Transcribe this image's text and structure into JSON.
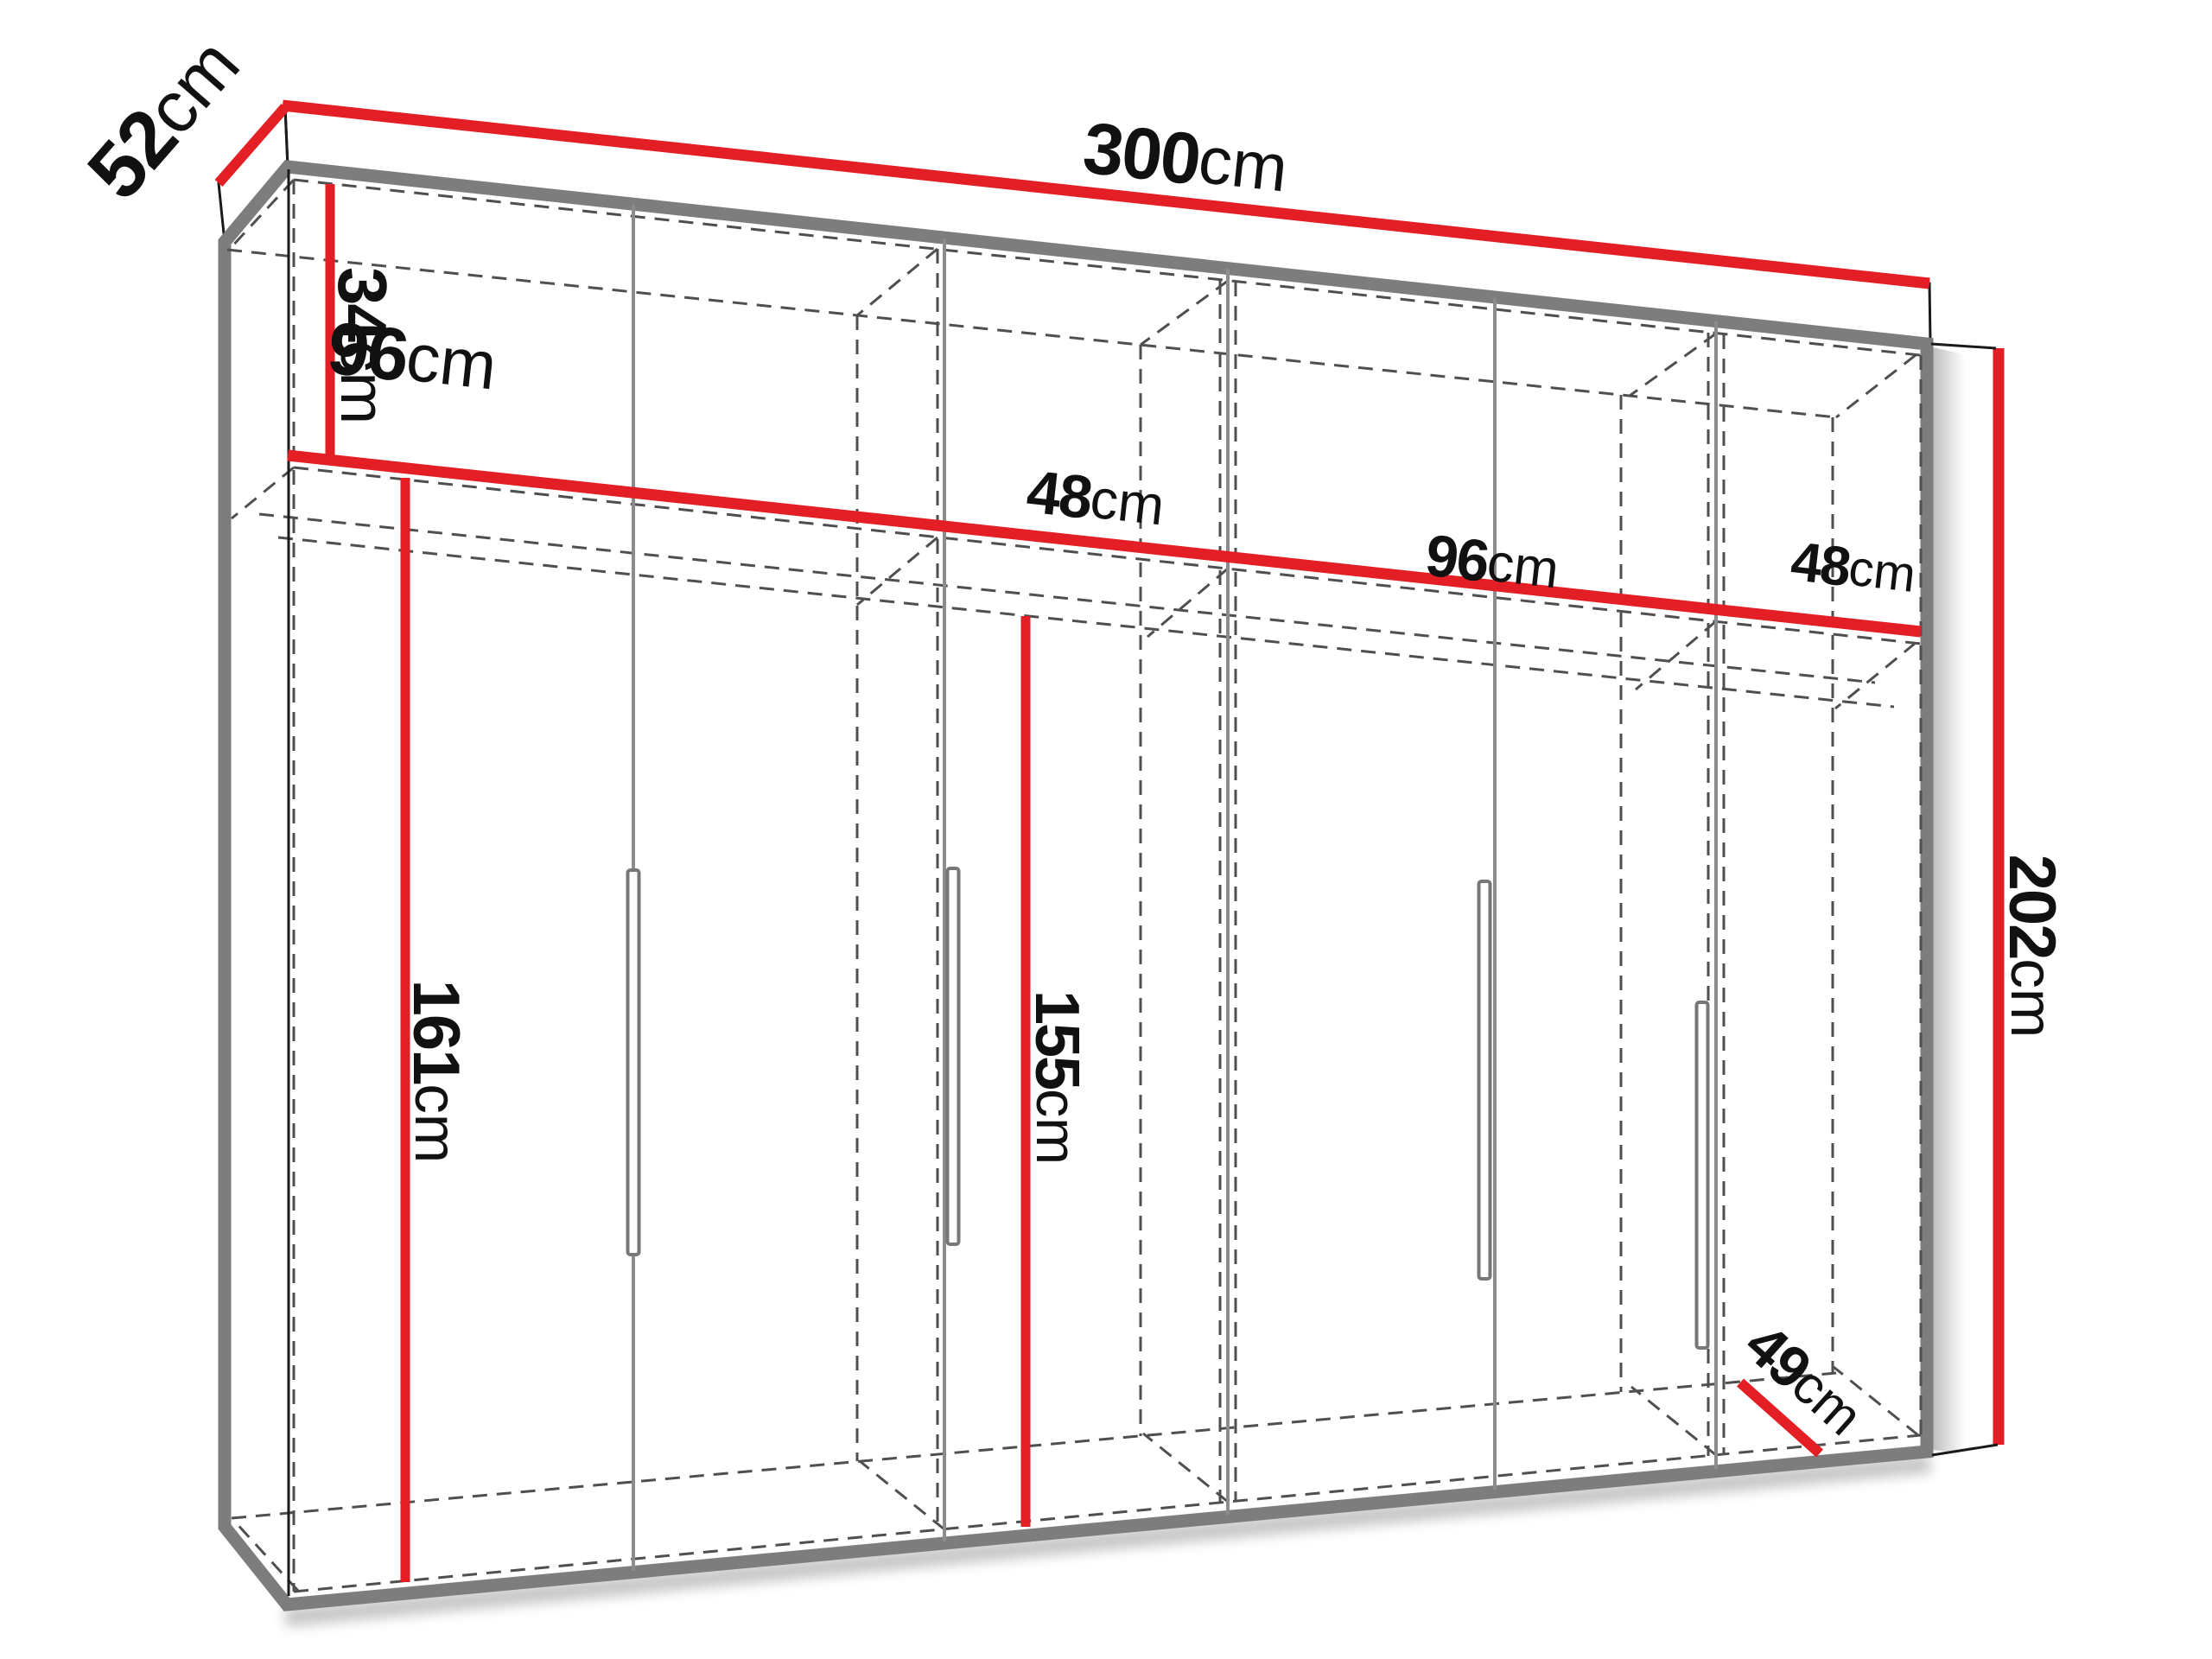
{
  "diagram": {
    "kind": "furniture-dimension-diagram",
    "subject": "wardrobe",
    "unit": "cm",
    "colors": {
      "dimension_line": "#e31e24",
      "edge": "#7d7d7d",
      "hidden_line": "#4f4f4f",
      "label_text": "#111111",
      "background": "#ffffff"
    },
    "labels": {
      "depth_top": {
        "value": "52",
        "unit": "cm"
      },
      "width_total": {
        "value": "300",
        "unit": "cm"
      },
      "top_compartment": {
        "value": "34",
        "unit": "cm"
      },
      "section_1": {
        "value": "96",
        "unit": "cm"
      },
      "section_2": {
        "value": "48",
        "unit": "cm"
      },
      "section_3": {
        "value": "96",
        "unit": "cm"
      },
      "section_4": {
        "value": "48",
        "unit": "cm"
      },
      "left_interior_height": {
        "value": "161",
        "unit": "cm"
      },
      "hanging_height": {
        "value": "155",
        "unit": "cm"
      },
      "height_total": {
        "value": "202",
        "unit": "cm"
      },
      "interior_depth": {
        "value": "49",
        "unit": "cm"
      }
    }
  }
}
